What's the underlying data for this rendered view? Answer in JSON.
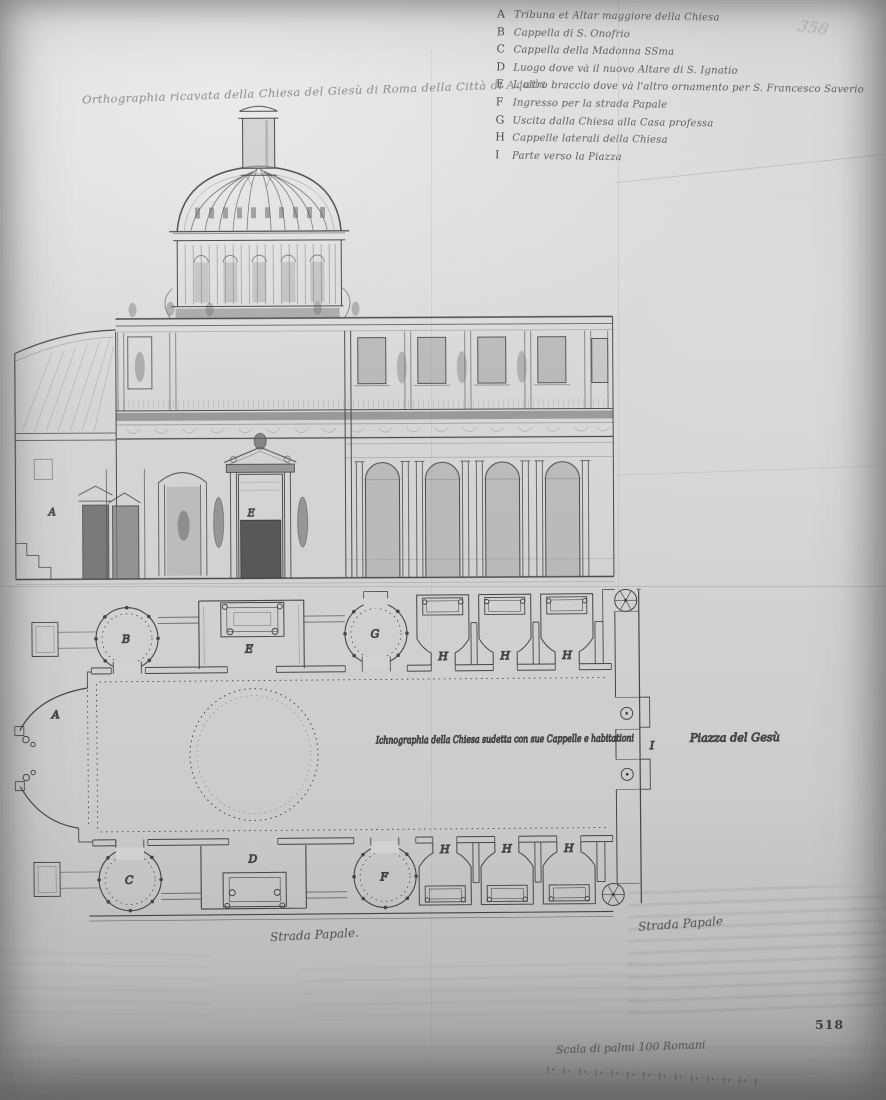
{
  "photo": {
    "pencil_folio": "358",
    "print_folio": "518",
    "stamp_line1": "·· ········ ··",
    "stamp_line2": "······ ····"
  },
  "elevation": {
    "title": "Orthographia ricavata della Chiesa del Giesù di Roma della Città di Aquila"
  },
  "legend": {
    "items": [
      {
        "key": "A",
        "text": "Tribuna et Altar maggiore della Chiesa"
      },
      {
        "key": "B",
        "text": "Cappella di S. Onofrio"
      },
      {
        "key": "C",
        "text": "Cappella della Madonna SSma"
      },
      {
        "key": "D",
        "text": "Luogo dove và il nuovo Altare di S. Ignatio"
      },
      {
        "key": "E",
        "text": "L'altro braccio dove và l'altro ornamento per S. Francesco Saverio"
      },
      {
        "key": "F",
        "text": "Ingresso per la strada Papale"
      },
      {
        "key": "G",
        "text": "Uscita dalla Chiesa alla Casa professa"
      },
      {
        "key": "H",
        "text": "Cappelle laterali della Chiesa"
      },
      {
        "key": "I",
        "text": "Parte verso la Piazza"
      }
    ]
  },
  "plan": {
    "caption": "Ichnographia della Chiesa sudetta con sue Cappelle e habitationi",
    "piazza_label": "Piazza del Gesù",
    "street_left": "Strada Papale.",
    "street_right": "Strada Papale",
    "scale_label": "Scala di palmi 100 Romani"
  },
  "letters": {
    "A": "A",
    "B": "B",
    "C": "C",
    "D": "D",
    "E": "E",
    "F": "F",
    "G": "G",
    "H": "H",
    "I": "I"
  },
  "colors": {
    "paper": "#d3d3d3",
    "ink": "#3a3a3a",
    "wash": "#8f8f8f"
  }
}
